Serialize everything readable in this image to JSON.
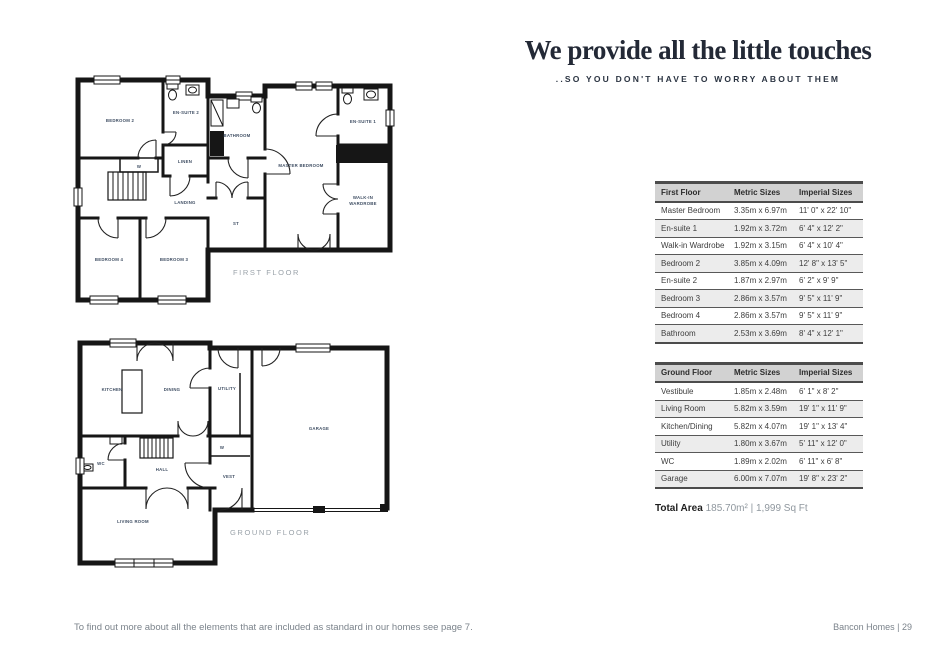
{
  "header": {
    "title": "We provide all the little touches",
    "subtitle": "..SO YOU DON'T HAVE TO WORRY ABOUT THEM"
  },
  "plans": {
    "first_floor": {
      "caption": "FIRST FLOOR",
      "rooms": {
        "bedroom2": "BEDROOM 2",
        "ensuite2": "EN-SUITE 2",
        "linen": "LINEN",
        "wardrobe_w": "W",
        "landing": "LANDING",
        "bathroom": "BATHROOM",
        "store": "ST",
        "master_bedroom": "MASTER BEDROOM",
        "ensuite1": "EN-SUITE 1",
        "walkin_line1": "WALK-IN",
        "walkin_line2": "WARDROBE",
        "bedroom4": "BEDROOM 4",
        "bedroom3": "BEDROOM 3"
      }
    },
    "ground_floor": {
      "caption": "GROUND FLOOR",
      "rooms": {
        "kitchen": "KITCHEN",
        "dining": "DINING",
        "utility": "UTILITY",
        "garage": "GARAGE",
        "wc": "WC",
        "hall": "HALL",
        "closet_w": "W",
        "vest": "VEST",
        "living_room": "LIVING ROOM"
      }
    }
  },
  "tables": {
    "first_floor": {
      "headers": [
        "First Floor",
        "Metric Sizes",
        "Imperial Sizes"
      ],
      "rows": [
        {
          "room": "Master Bedroom",
          "metric": "3.35m x 6.97m",
          "imperial": "11' 0\" x 22' 10\""
        },
        {
          "room": "En-suite 1",
          "metric": "1.92m x 3.72m",
          "imperial": "6' 4\" x 12' 2\""
        },
        {
          "room": "Walk-in Wardrobe",
          "metric": "1.92m x 3.15m",
          "imperial": "6' 4\" x 10' 4\""
        },
        {
          "room": "Bedroom 2",
          "metric": "3.85m x 4.09m",
          "imperial": "12' 8\" x 13' 5\""
        },
        {
          "room": "En-suite 2",
          "metric": "1.87m x 2.97m",
          "imperial": "6' 2\" x 9' 9\""
        },
        {
          "room": "Bedroom 3",
          "metric": "2.86m x 3.57m",
          "imperial": "9' 5\" x 11' 9\""
        },
        {
          "room": "Bedroom 4",
          "metric": "2.86m x 3.57m",
          "imperial": "9' 5\" x 11' 9\""
        },
        {
          "room": "Bathroom",
          "metric": "2.53m x 3.69m",
          "imperial": "8' 4\" x 12' 1\""
        }
      ]
    },
    "ground_floor": {
      "headers": [
        "Ground Floor",
        "Metric Sizes",
        "Imperial Sizes"
      ],
      "rows": [
        {
          "room": "Vestibule",
          "metric": "1.85m x 2.48m",
          "imperial": "6' 1\" x 8' 2\""
        },
        {
          "room": "Living Room",
          "metric": "5.82m x 3.59m",
          "imperial": "19' 1\" x 11' 9\""
        },
        {
          "room": "Kitchen/Dining",
          "metric": "5.82m x 4.07m",
          "imperial": "19' 1\" x 13' 4\""
        },
        {
          "room": "Utility",
          "metric": "1.80m x 3.67m",
          "imperial": "5' 11\" x 12' 0\""
        },
        {
          "room": "WC",
          "metric": "1.89m x 2.02m",
          "imperial": "6' 11\" x 6' 8\""
        },
        {
          "room": "Garage",
          "metric": "6.00m x 7.07m",
          "imperial": "19' 8\" x 23' 2\""
        }
      ]
    },
    "total_area_label": "Total Area",
    "total_area_value": "185.70m² | 1,999 Sq Ft"
  },
  "footer": {
    "note": "To find out more about all the elements that are included as standard in our homes see page 7.",
    "page_label": "Bancon Homes | 29"
  },
  "colors": {
    "heading": "#232936",
    "table_header_bg": "#d2d2d2",
    "table_row_alt_bg": "#ececec",
    "table_border": "#4c4c4c",
    "plan_wall": "#161616",
    "plan_label": "#3f4e63",
    "caption": "#9aa2a9",
    "footer_text": "#7b838b"
  }
}
